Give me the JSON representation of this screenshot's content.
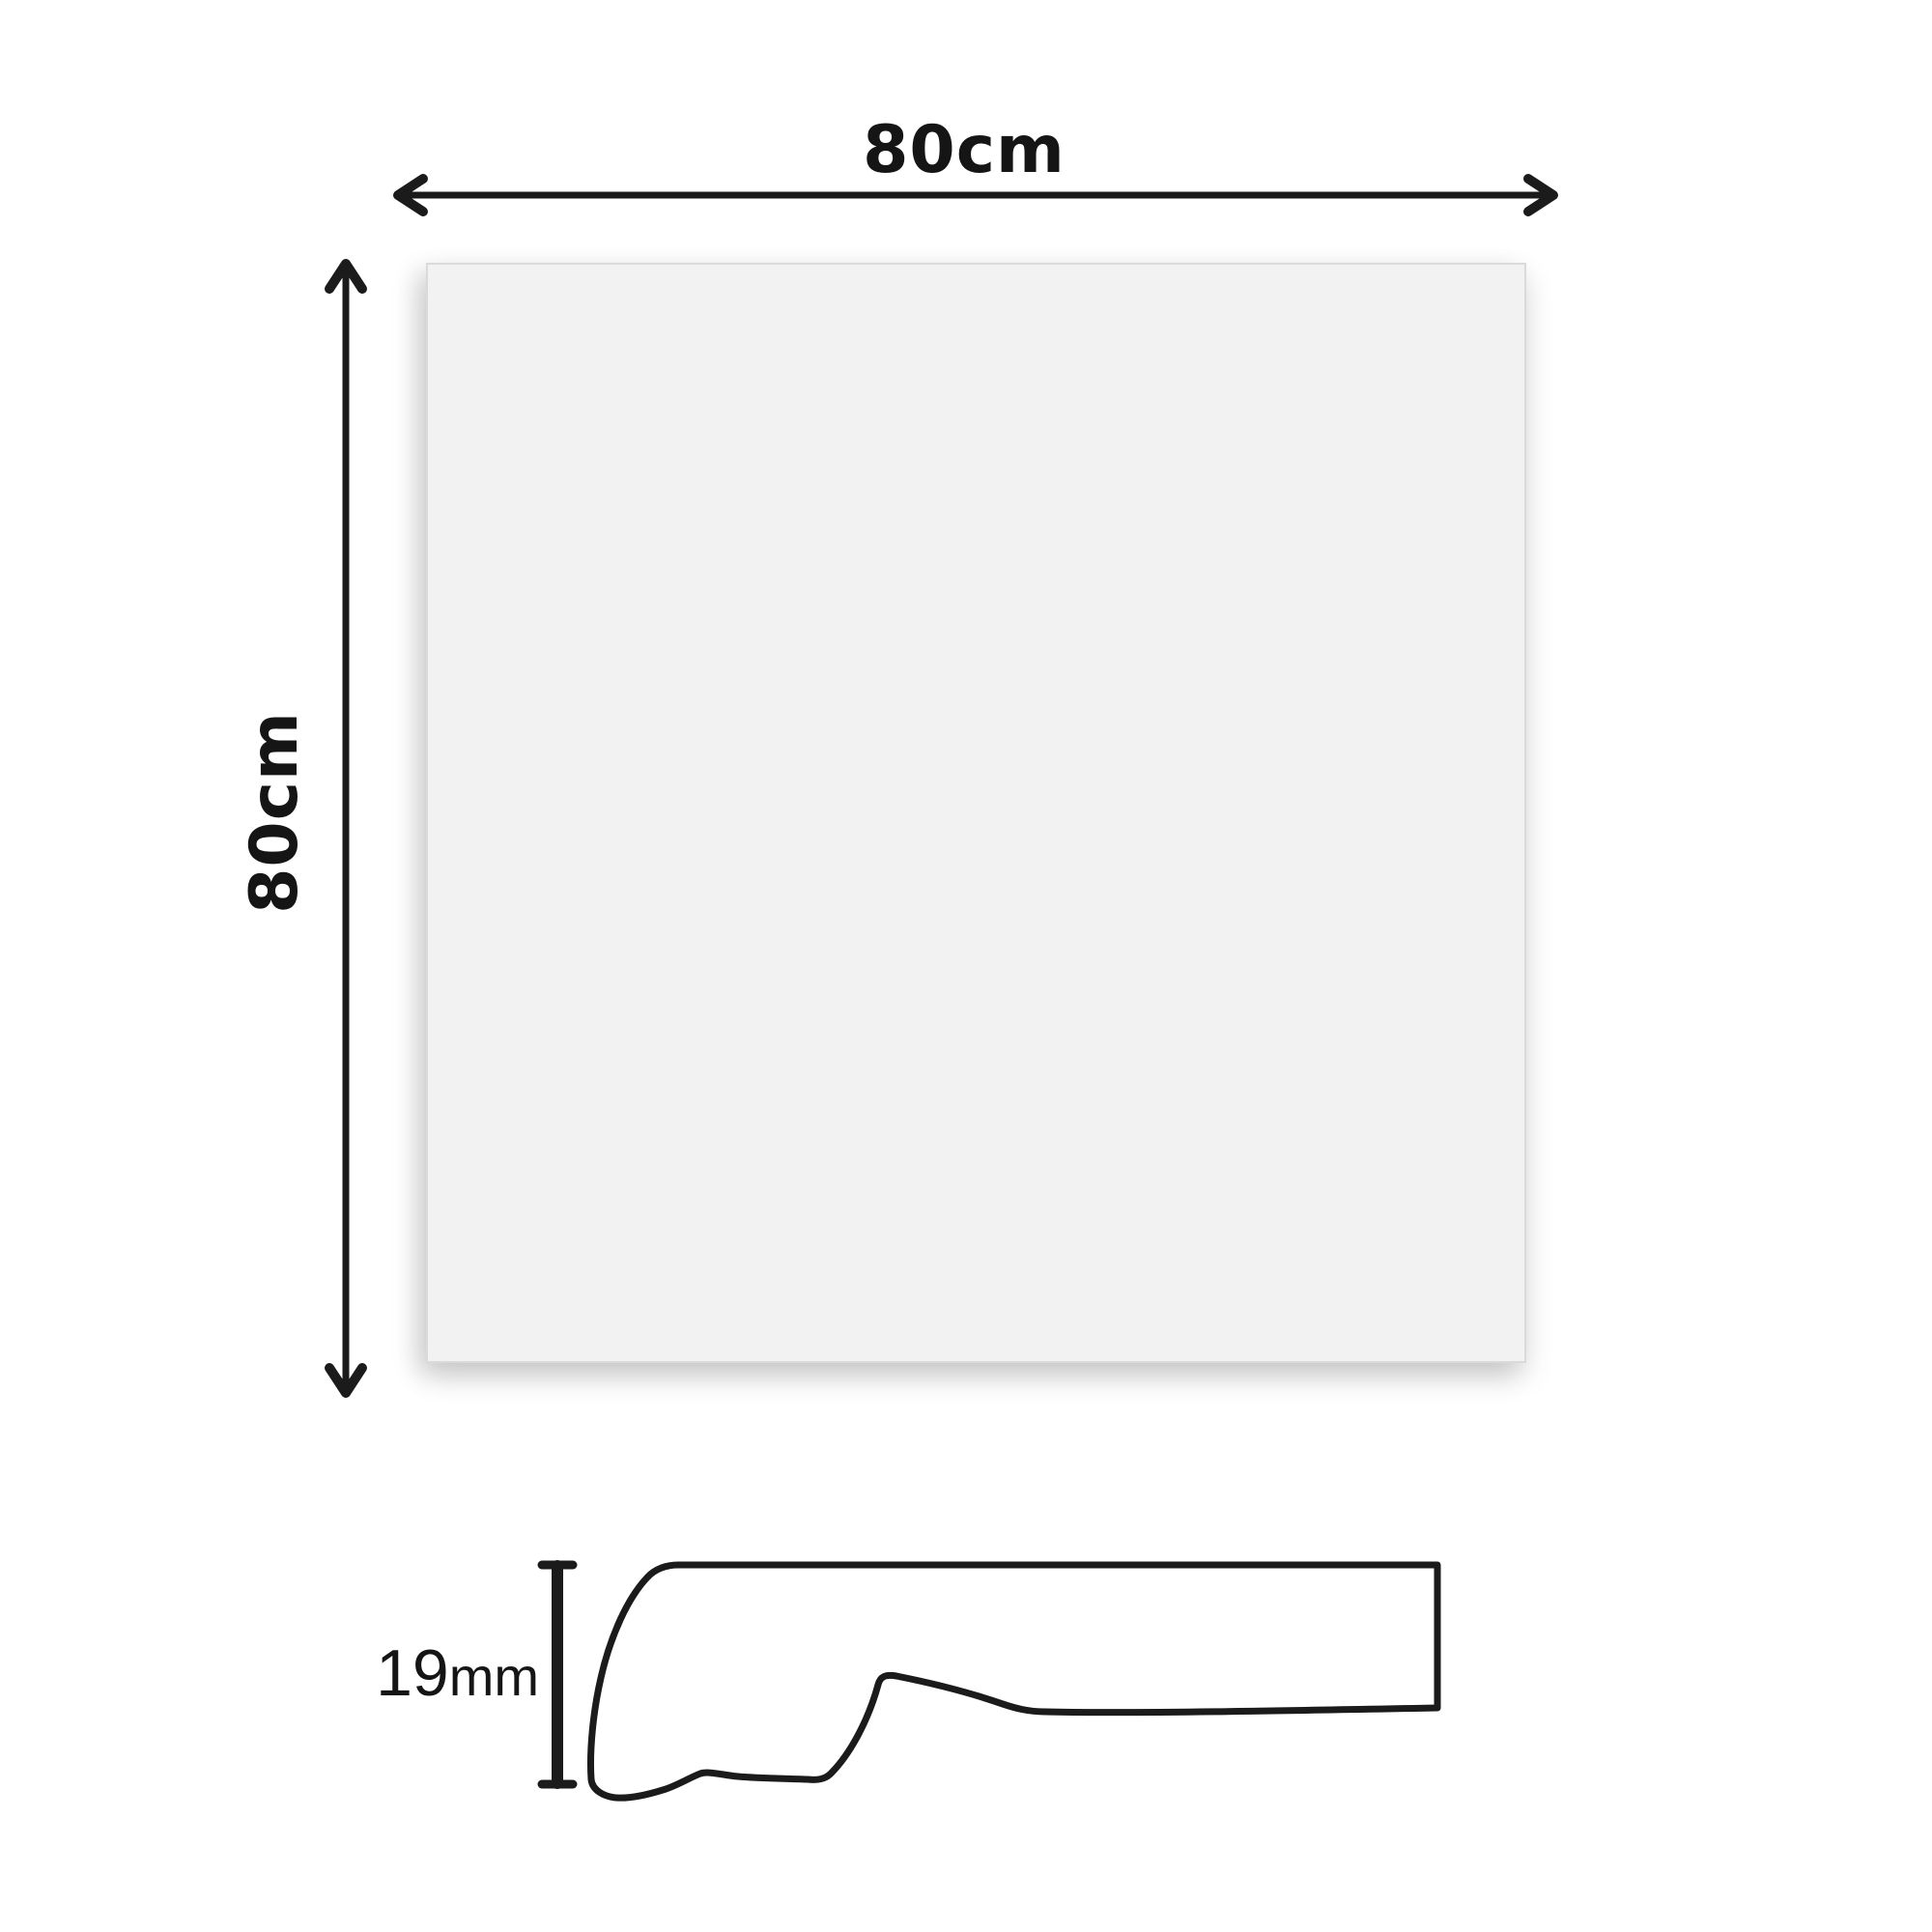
{
  "diagram": {
    "type": "product-dimension-diagram",
    "width_label": "80cm",
    "height_label": "80cm",
    "thickness_value": "19",
    "thickness_unit": "mm",
    "colors": {
      "line": "#1b1b1b",
      "panel_fill": "#f2f2f2",
      "panel_border": "#dadada",
      "background": "#ffffff"
    }
  }
}
